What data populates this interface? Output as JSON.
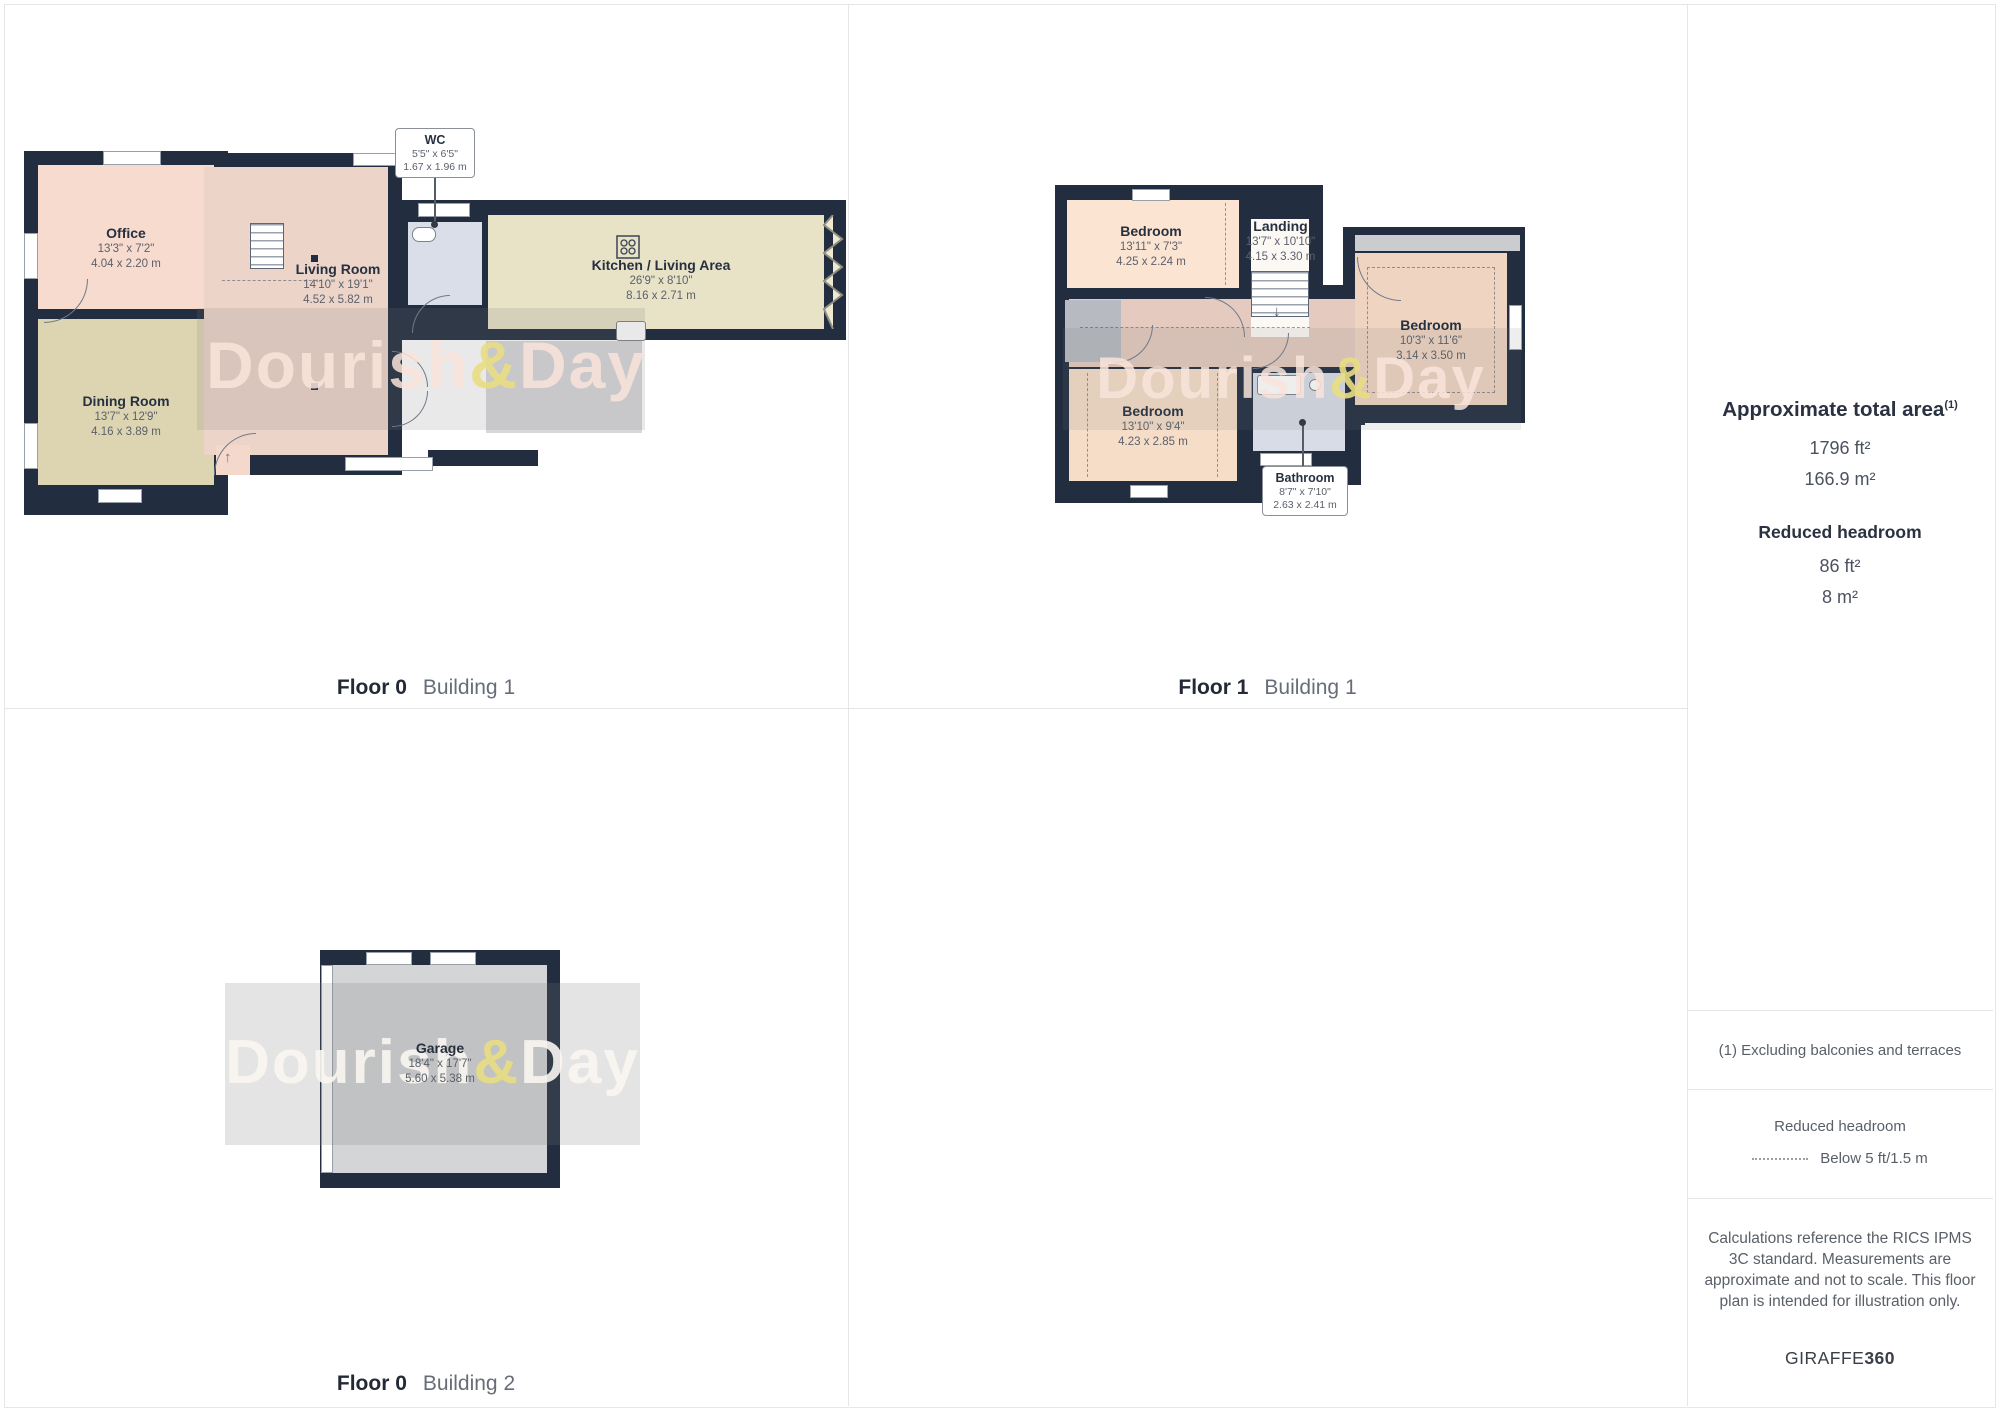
{
  "panels": [
    {
      "floor_label": "Floor 0",
      "building_label": "Building 1",
      "rooms": [
        {
          "name": "Office",
          "dims_ft": "13'3\" x 7'2\"",
          "dims_m": "4.04 x 2.20 m"
        },
        {
          "name": "Dining Room",
          "dims_ft": "13'7\" x 12'9\"",
          "dims_m": "4.16 x 3.89 m"
        },
        {
          "name": "Living Room",
          "dims_ft": "14'10\" x 19'1\"",
          "dims_m": "4.52 x 5.82 m"
        },
        {
          "name": "WC",
          "dims_ft": "5'5\" x 6'5\"",
          "dims_m": "1.67 x 1.96 m"
        },
        {
          "name": "Kitchen / Living Area",
          "dims_ft": "26'9\" x 8'10\"",
          "dims_m": "8.16 x 2.71 m"
        }
      ]
    },
    {
      "floor_label": "Floor 1",
      "building_label": "Building 1",
      "rooms": [
        {
          "name": "Bedroom",
          "dims_ft": "13'11\" x 7'3\"",
          "dims_m": "4.25 x 2.24 m"
        },
        {
          "name": "Landing",
          "dims_ft": "13'7\" x 10'10\"",
          "dims_m": "4.15 x 3.30 m"
        },
        {
          "name": "Bedroom",
          "dims_ft": "10'3\" x 11'6\"",
          "dims_m": "3.14 x 3.50 m"
        },
        {
          "name": "Bedroom",
          "dims_ft": "13'10\" x 9'4\"",
          "dims_m": "4.23 x 2.85 m"
        },
        {
          "name": "Bathroom",
          "dims_ft": "8'7\" x 7'10\"",
          "dims_m": "2.63 x 2.41 m"
        }
      ]
    },
    {
      "floor_label": "Floor 0",
      "building_label": "Building 2",
      "rooms": [
        {
          "name": "Garage",
          "dims_ft": "18'4\" x 17'7\"",
          "dims_m": "5.60 x 5.38 m"
        }
      ]
    }
  ],
  "watermark": {
    "part1": "Dourish",
    "amp": "&",
    "part2": "Day"
  },
  "icons": {
    "arrow_up": "↑",
    "arrow_down": "↓"
  },
  "sidebar": {
    "total_area_title": "Approximate total area",
    "total_area_footnote_marker": "(1)",
    "total_area_ft": "1796 ft²",
    "total_area_m": "166.9 m²",
    "reduced_headroom_title": "Reduced headroom",
    "reduced_headroom_ft": "86 ft²",
    "reduced_headroom_m": "8 m²",
    "footnote": "(1) Excluding balconies and terraces",
    "legend_title": "Reduced headroom",
    "legend_label": "Below 5 ft/1.5 m",
    "disclaimer": "Calculations reference the RICS IPMS 3C standard. Measurements are approximate and not to scale. This floor plan is intended for illustration only.",
    "brand_name": "GIRAFFE",
    "brand_suffix": "360"
  },
  "colors": {
    "wall": "#222e40",
    "office_floor": "#f7dbce",
    "dining_floor": "#ddd5b2",
    "living_floor": "#ecd4c9",
    "kitchen_floor": "#e8e2c7",
    "wet_room_floor": "#d9dee8",
    "garage_floor": "#d4d5d6",
    "watermark_amp": "#e9dd82",
    "divider": "#e5e6e8"
  }
}
